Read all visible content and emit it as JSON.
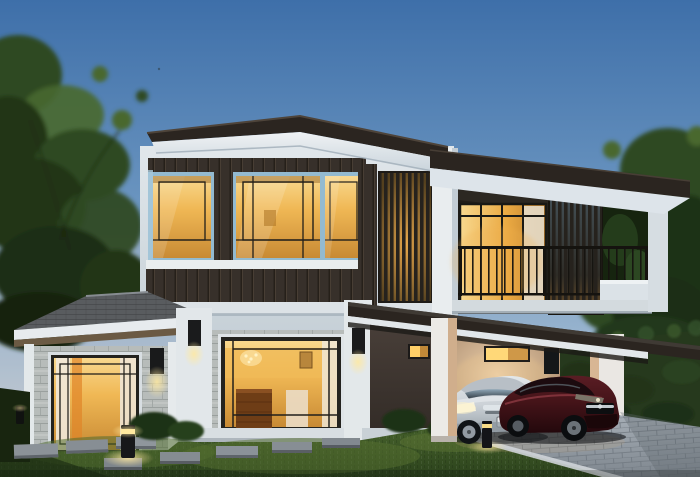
{
  "scene": {
    "type": "3d-architectural-rendering",
    "subject": "Modern two-storey house exterior at dusk with lit interiors",
    "time_of_day": "dusk",
    "sky": "clear gradient twilight",
    "interior_lights_on": true
  },
  "palette": {
    "sky_top": "#3e6fa9",
    "sky_mid": "#6d97c1",
    "sky_low": "#a5bcd2",
    "sky_horizon": "#d7d2d4",
    "tree_dark": "#203518",
    "tree_mid": "#2e4a23",
    "tree_light": "#48682f",
    "roof_dark": "#2b2520",
    "roof_ridge": "#4e443a",
    "fascia_white": "#eff2f4",
    "fascia_shade": "#c7d2da",
    "wall_white": "#e1e7eb",
    "wall_shade": "#c6d0d7",
    "window_frame_blue": "#93bad0",
    "glass_amber": "#f0b855",
    "glass_amber_bright": "#f8d88e",
    "glass_amber_deep": "#c88a34",
    "mullion_dark": "#211f1a",
    "wood_panel": "#37302a",
    "louver_dark": "#26221d",
    "railing_dark": "#15130f",
    "stone_wall": "#b7bcba",
    "stone_joint": "#9aa09e",
    "shingle_gray": "#595c5f",
    "hedge_dark": "#26391d",
    "hedge_light": "#3c5829",
    "lawn_base": "#3a5224",
    "lawn_bright": "#5d7833",
    "lawn_shadow": "#1e2f14",
    "paver_stone": "#868d93",
    "drive_light": "#a8b0b8",
    "drive_dark": "#7e868e",
    "car_silver": "#ccd2d7",
    "car_silver_shadow": "#98a2a9",
    "car_red": "#451419",
    "car_red_highlight": "#8c3a42",
    "carport_wall": "#dcc2a2",
    "warm_glow": "#ffe9a0",
    "porch_dark": "#332c27",
    "curb_white": "#cfd4d8"
  },
  "objects": {
    "house": {
      "storeys": 2,
      "features": [
        "hip roof",
        "second-floor glass window band",
        "vertical louver screens",
        "balcony with dark metal railing",
        "stone brick cladding",
        "covered carport",
        "recessed entry porch",
        "wall sconces"
      ]
    },
    "vehicles": [
      {
        "name": "silver-sedan",
        "body_color": "silver",
        "position": "carport left",
        "headlights": "reflecting"
      },
      {
        "name": "dark-red-coupe",
        "body_color": "dark red",
        "position": "carport right"
      }
    ],
    "landscape": [
      "front lawn",
      "stepping stones",
      "bollard lights",
      "clipped hedge wall",
      "mature trees",
      "paver driveway",
      "foundation shrubs"
    ],
    "lighting": [
      "amber interior lighting",
      "wall sconces",
      "bollard path lights"
    ]
  }
}
